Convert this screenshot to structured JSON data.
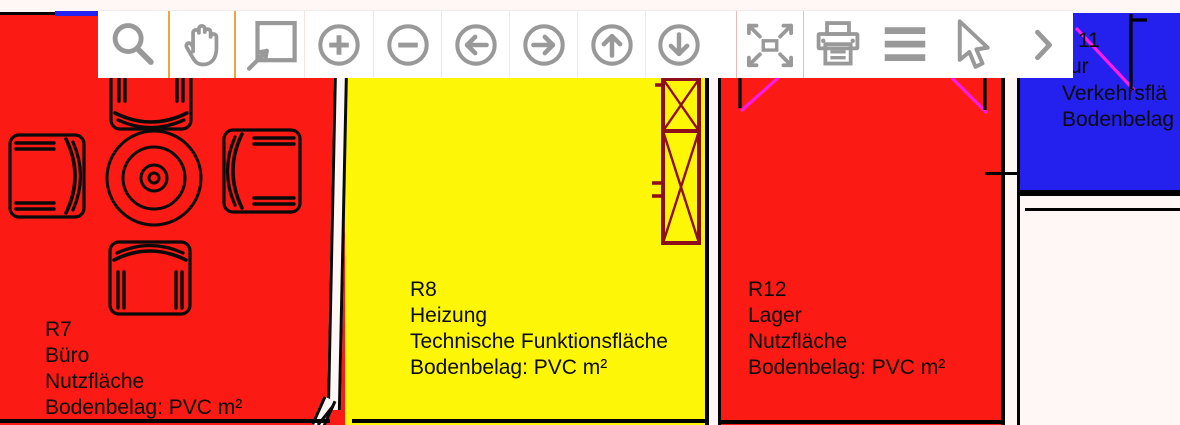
{
  "app": {
    "description": "Floor plan viewer with navigation toolbar"
  },
  "toolbar": {
    "icons": [
      "magnifier-icon",
      "hand-pan-icon",
      "zoom-window-icon",
      "zoom-in-icon",
      "zoom-out-icon",
      "pan-left-icon",
      "pan-right-icon",
      "pan-up-icon",
      "pan-down-icon",
      "fit-extents-icon",
      "printer-icon",
      "menu-icon",
      "cursor-icon",
      "chevron-right-icon"
    ],
    "active_tool": "hand-pan"
  },
  "rooms": {
    "r7": {
      "lines": [
        "R7",
        "Büro",
        "Nutzfläche",
        "Bodenbelag: PVC m²"
      ],
      "color": "#fb1a14"
    },
    "r8": {
      "lines": [
        "R8",
        "Heizung",
        "Technische Funktionsfläche",
        "Bodenbelag: PVC m²"
      ],
      "color": "#fdf607"
    },
    "r12": {
      "lines": [
        "R12",
        "Lager",
        "Nutzfläche",
        "Bodenbelag: PVC m²"
      ],
      "color": "#fb1a14"
    },
    "r11": {
      "lines": [
        "11",
        "ur",
        "Verkehrsflä",
        "Bodenbelag"
      ],
      "color": "#2420ee"
    }
  },
  "colors": {
    "room_red": "#fb1a14",
    "room_yellow": "#fdf607",
    "room_blue": "#2420ee",
    "door_magenta": "#ff1ae8",
    "column_maroon": "#8d0f1c",
    "icon_gray": "#999999",
    "separator_orange": "#f0a53c",
    "background": "#fff7f6",
    "line_black": "#000000"
  }
}
